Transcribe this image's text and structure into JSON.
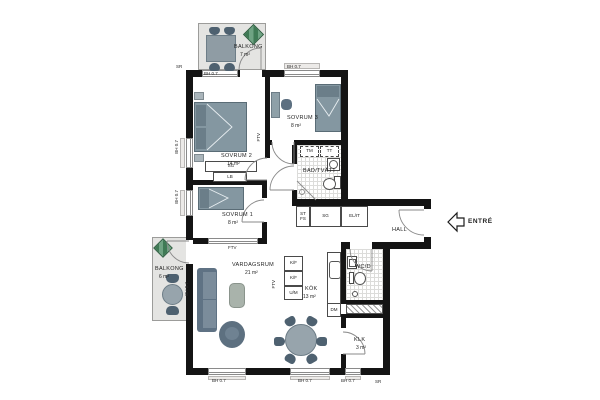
{
  "rooms": {
    "balkong_top": {
      "name": "BALKONG",
      "area": "7 m²"
    },
    "sovrum2": {
      "name": "SOVRUM 2",
      "area": "14 m²"
    },
    "sovrum3": {
      "name": "SOVRUM 3",
      "area": "8 m²"
    },
    "badtvatt": {
      "name": "BAD/TVÄTT"
    },
    "sovrum1": {
      "name": "SOVRUM 1",
      "area": "8 m²"
    },
    "hall": {
      "name": "HALL"
    },
    "entre": {
      "name": "ENTRÉ"
    },
    "vardagsrum": {
      "name": "VARDAGSRUM",
      "area": "21 m²"
    },
    "kok": {
      "name": "KÖK",
      "area": "13 m²"
    },
    "wcd": {
      "name": "WC/D"
    },
    "klk": {
      "name": "KLK",
      "area": "3 m²"
    },
    "balkong_left": {
      "name": "BALKONG",
      "area": "6 m²"
    }
  },
  "fixtures": {
    "tm": "TM",
    "tt": "TT",
    "st": "ST",
    "fs": "FS",
    "sg_hall": "SG",
    "el_it": "EL/IT",
    "sg_sovrum": "SG",
    "lb": "LB",
    "kf": "K/F",
    "um": "U/M",
    "dm": "DM"
  },
  "annotations": {
    "bh": "BH 0.7",
    "sr": "SR",
    "ftv": "FTV"
  },
  "colors": {
    "wall": "#141414",
    "balcony_floor": "#e4e4e2",
    "furniture": "#8497a1",
    "furniture_dark": "#5f7284",
    "table": "#97a4ac",
    "plant_green": "#3f7a55",
    "tile_line": "#dcdcda",
    "door_line": "#8a8a8a"
  }
}
